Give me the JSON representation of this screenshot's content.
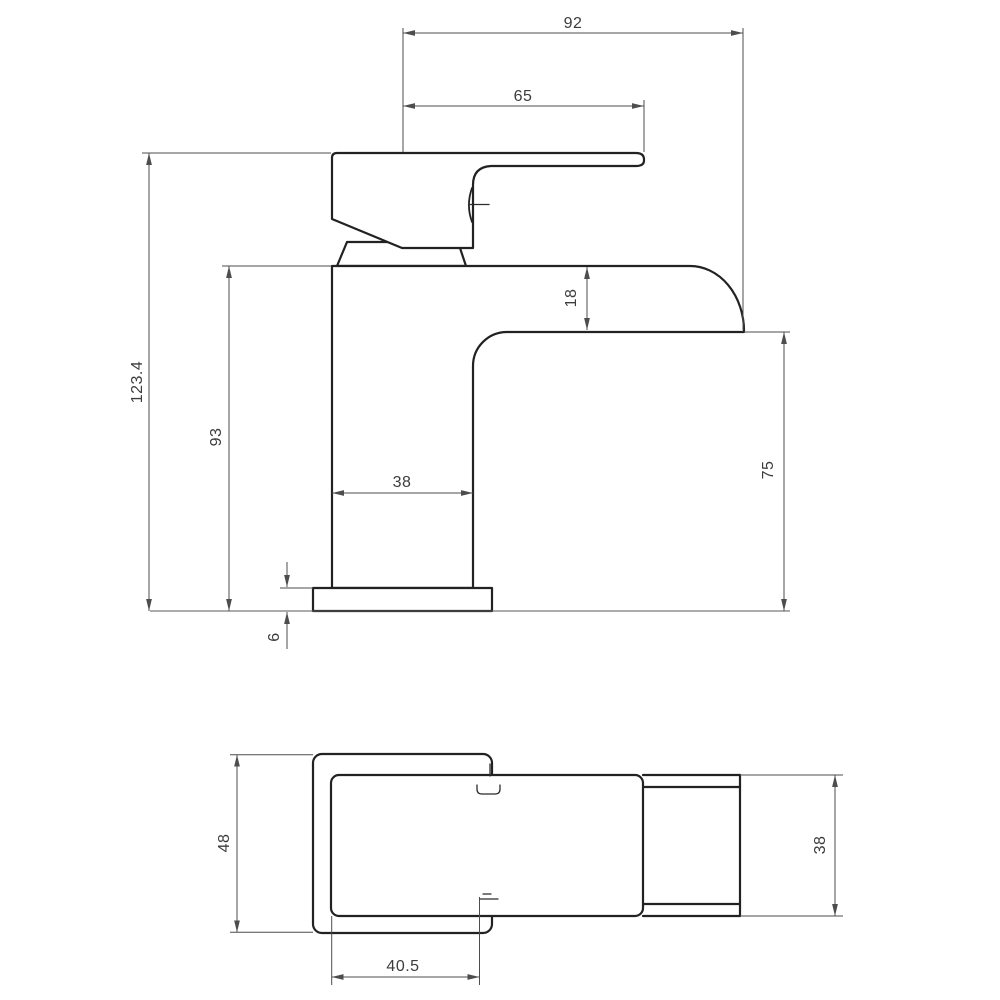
{
  "drawing": {
    "type": "technical-dimension-drawing",
    "subject": "waterfall basin mixer tap",
    "colors": {
      "background": "#ffffff",
      "object_line": "#222222",
      "dimension_line": "#4d4d4d",
      "text": "#3c3c3c"
    },
    "side_view": {
      "spout_reach": "92",
      "handle_reach": "65",
      "overall_height": "123.4",
      "body_height": "93",
      "body_width": "38",
      "spout_thickness": "18",
      "spout_clearance": "75",
      "base_plate_thickness": "6"
    },
    "plan_view": {
      "base_plate_depth": "48",
      "spout_width": "38",
      "inlet_offset": "40.5"
    }
  }
}
